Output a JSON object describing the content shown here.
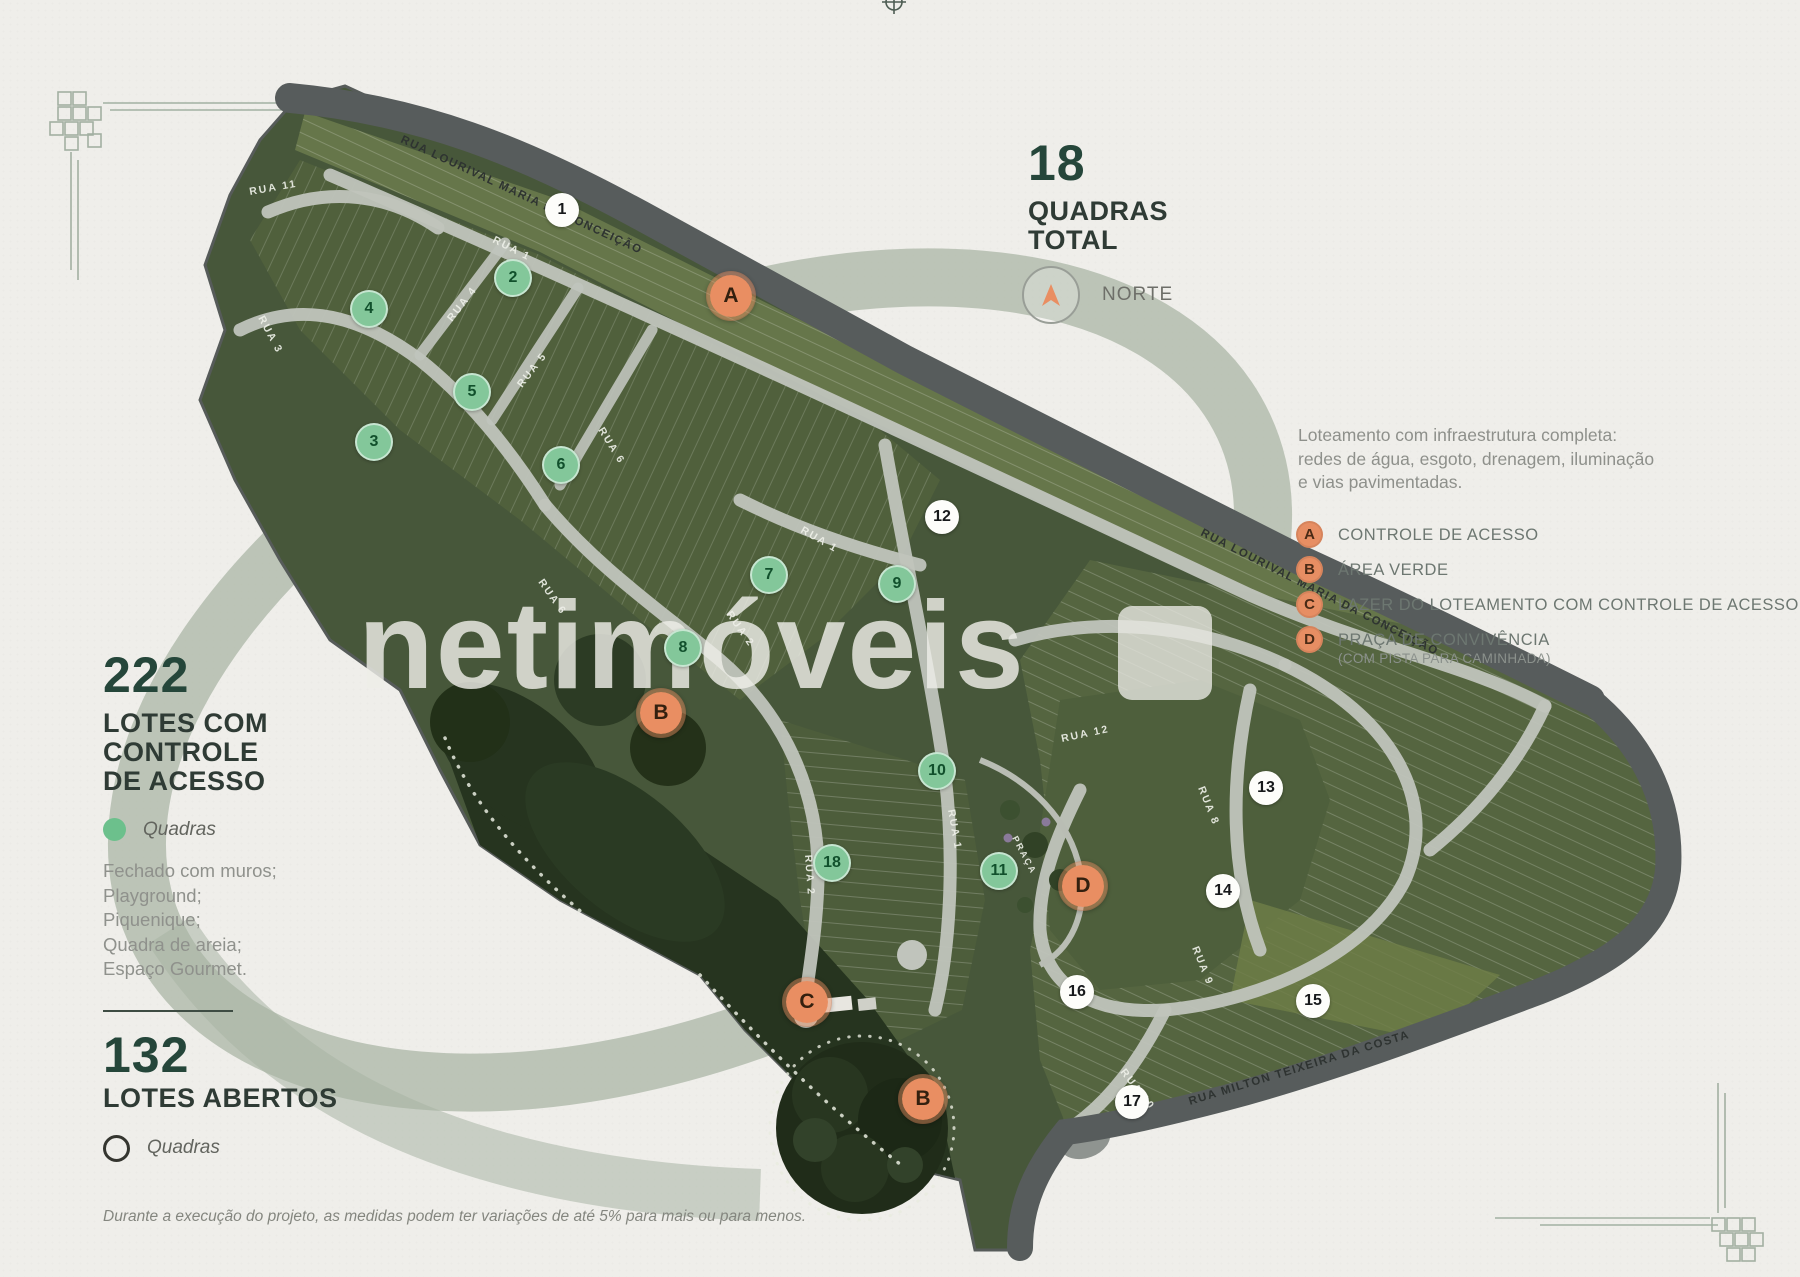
{
  "watermark": "netimóveis",
  "disclaimer": "Durante a execução do projeto, as medidas podem ter variações de até 5% para mais ou para menos.",
  "left_panel": {
    "closed_lots": {
      "value": "222",
      "label_lines": [
        "LOTES COM",
        "CONTROLE",
        "DE ACESSO"
      ],
      "legend_label": "Quadras"
    },
    "features": [
      "Fechado com muros;",
      "Playground;",
      "Piquenique;",
      "Quadra de areia;",
      "Espaço Gourmet."
    ],
    "open_lots": {
      "value": "132",
      "label": "LOTES ABERTOS",
      "legend_label": "Quadras"
    }
  },
  "right_panel": {
    "quadras_total": {
      "value": "18",
      "label_lines": [
        "QUADRAS",
        "TOTAL"
      ]
    },
    "north_label": "NORTE",
    "infrastructure_lines": [
      "Loteamento com infraestrutura completa:",
      "redes de água, esgoto, drenagem, iluminação",
      "e vias pavimentadas."
    ],
    "legend": [
      {
        "key": "A",
        "label": "CONTROLE DE ACESSO",
        "sublabel": ""
      },
      {
        "key": "B",
        "label": "ÁREA VERDE",
        "sublabel": ""
      },
      {
        "key": "C",
        "label": "LAZER DO LOTEAMENTO COM CONTROLE DE ACESSO",
        "sublabel": ""
      },
      {
        "key": "D",
        "label": "PRAÇA DE CONVIVÊNCIA",
        "sublabel": "(COM PISTA PARA CAMINHADA)"
      }
    ]
  },
  "map": {
    "roads": [
      {
        "text": "RUA LOURIVAL MARIA DA CONCEIÇÃO"
      },
      {
        "text": "RUA LOURIVAL MARIA DA CONCEIÇÃO"
      },
      {
        "text": "RUA MILTON TEIXEIRA DA COSTA"
      }
    ],
    "streets": [
      {
        "text": "RUA 11"
      },
      {
        "text": "RUA 3"
      },
      {
        "text": "RUA 1"
      },
      {
        "text": "RUA 4"
      },
      {
        "text": "RUA 5"
      },
      {
        "text": "RUA 6"
      },
      {
        "text": "RUA 6"
      },
      {
        "text": "RUA 1"
      },
      {
        "text": "RUA 2"
      },
      {
        "text": "RUA 2"
      },
      {
        "text": "RUA 1"
      },
      {
        "text": "RUA 12"
      },
      {
        "text": "RUA 8"
      },
      {
        "text": "RUA 9"
      },
      {
        "text": "RUA 10"
      },
      {
        "text": "PRAÇA"
      }
    ],
    "markers": [
      {
        "label": "1",
        "kind": "quadra-open",
        "x": 562,
        "y": 210
      },
      {
        "label": "2",
        "kind": "quadra-green",
        "x": 513,
        "y": 278
      },
      {
        "label": "3",
        "kind": "quadra-green",
        "x": 374,
        "y": 442
      },
      {
        "label": "4",
        "kind": "quadra-green",
        "x": 369,
        "y": 309
      },
      {
        "label": "5",
        "kind": "quadra-green",
        "x": 472,
        "y": 392
      },
      {
        "label": "6",
        "kind": "quadra-green",
        "x": 561,
        "y": 465
      },
      {
        "label": "7",
        "kind": "quadra-green",
        "x": 769,
        "y": 575
      },
      {
        "label": "8",
        "kind": "quadra-green",
        "x": 683,
        "y": 648
      },
      {
        "label": "9",
        "kind": "quadra-green",
        "x": 897,
        "y": 584
      },
      {
        "label": "10",
        "kind": "quadra-green",
        "x": 937,
        "y": 771
      },
      {
        "label": "11",
        "kind": "quadra-green",
        "x": 999,
        "y": 871
      },
      {
        "label": "12",
        "kind": "quadra-open",
        "x": 942,
        "y": 517
      },
      {
        "label": "13",
        "kind": "quadra-open",
        "x": 1266,
        "y": 788
      },
      {
        "label": "14",
        "kind": "quadra-open",
        "x": 1223,
        "y": 891
      },
      {
        "label": "15",
        "kind": "quadra-open",
        "x": 1313,
        "y": 1001
      },
      {
        "label": "16",
        "kind": "quadra-open",
        "x": 1077,
        "y": 992
      },
      {
        "label": "17",
        "kind": "quadra-open",
        "x": 1132,
        "y": 1102
      },
      {
        "label": "18",
        "kind": "quadra-green",
        "x": 832,
        "y": 863
      },
      {
        "label": "A",
        "kind": "poi",
        "x": 731,
        "y": 296
      },
      {
        "label": "B",
        "kind": "poi",
        "x": 661,
        "y": 713
      },
      {
        "label": "B",
        "kind": "poi",
        "x": 923,
        "y": 1099
      },
      {
        "label": "C",
        "kind": "poi",
        "x": 807,
        "y": 1002
      },
      {
        "label": "D",
        "kind": "poi",
        "x": 1083,
        "y": 886
      }
    ]
  },
  "colors": {
    "accent_orange": "#e98e62",
    "accent_green": "#6cc08c",
    "headline_green": "#25463a",
    "sage": "#a8b4a4"
  }
}
